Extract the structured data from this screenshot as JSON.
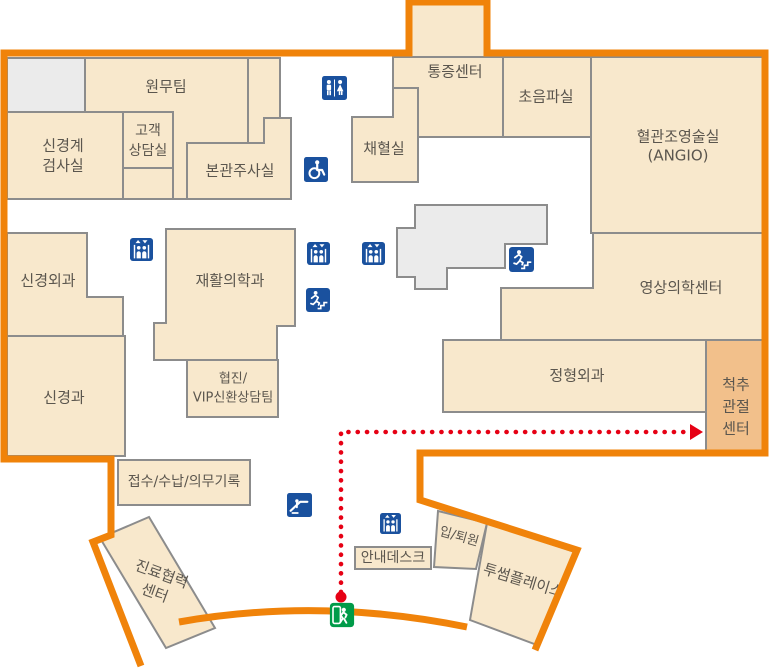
{
  "map": {
    "type": "hospital-floor-plan",
    "rooms": {
      "admin_team": {
        "label": "원무팀"
      },
      "neuro_exam": {
        "l1": "신경계",
        "l2": "검사실"
      },
      "customer_consult": {
        "l1": "고객",
        "l2": "상담실"
      },
      "main_injection": {
        "label": "본관주사실"
      },
      "blood_collection": {
        "label": "채혈실"
      },
      "pain_center": {
        "label": "통증센터"
      },
      "ultrasound": {
        "label": "초음파실"
      },
      "angio": {
        "l1": "혈관조영술실",
        "l2": "(ANGIO)"
      },
      "neurosurgery": {
        "label": "신경외과"
      },
      "rehab_medicine": {
        "label": "재활의학과"
      },
      "imaging_center": {
        "label": "영상의학센터"
      },
      "neurology": {
        "label": "신경과"
      },
      "coop_vip": {
        "l1": "협진/",
        "l2": "VIP신환상담팀"
      },
      "orthopedics": {
        "label": "정형외과"
      },
      "spine_joint_center": {
        "l1": "척추",
        "l2": "관절",
        "l3": "센터"
      },
      "reception": {
        "label": "접수/수납/의무기록"
      },
      "care_coop_center": {
        "l1": "진료협력",
        "l2": "센터"
      },
      "info_desk": {
        "label": "안내데스크"
      },
      "admission_discharge": {
        "label": "입/퇴원"
      },
      "twosome_place": {
        "label": "투썸플레이스"
      }
    },
    "icons": {
      "restroom": "restroom-icon",
      "wheelchair": "wheelchair-access-icon",
      "elevator": "elevator-icon",
      "emergency_stairs": "emergency-stairs-icon",
      "escalator": "escalator-icon",
      "emergency_exit": "emergency-exit-icon"
    },
    "route": {
      "style": "dotted",
      "color": "#e60014",
      "start_marker": "dot",
      "end_marker": "arrow"
    },
    "colors": {
      "boundary_orange": "#f0830a",
      "room_fill": "#f8e8cc",
      "highlight_fill": "#f2c08b",
      "room_stroke": "#8c8c8c",
      "gray_fill": "#ebebeb",
      "icon_blue": "#1a519e",
      "exit_green": "#009b49",
      "route_red": "#e60014",
      "text": "#5b564e"
    }
  }
}
